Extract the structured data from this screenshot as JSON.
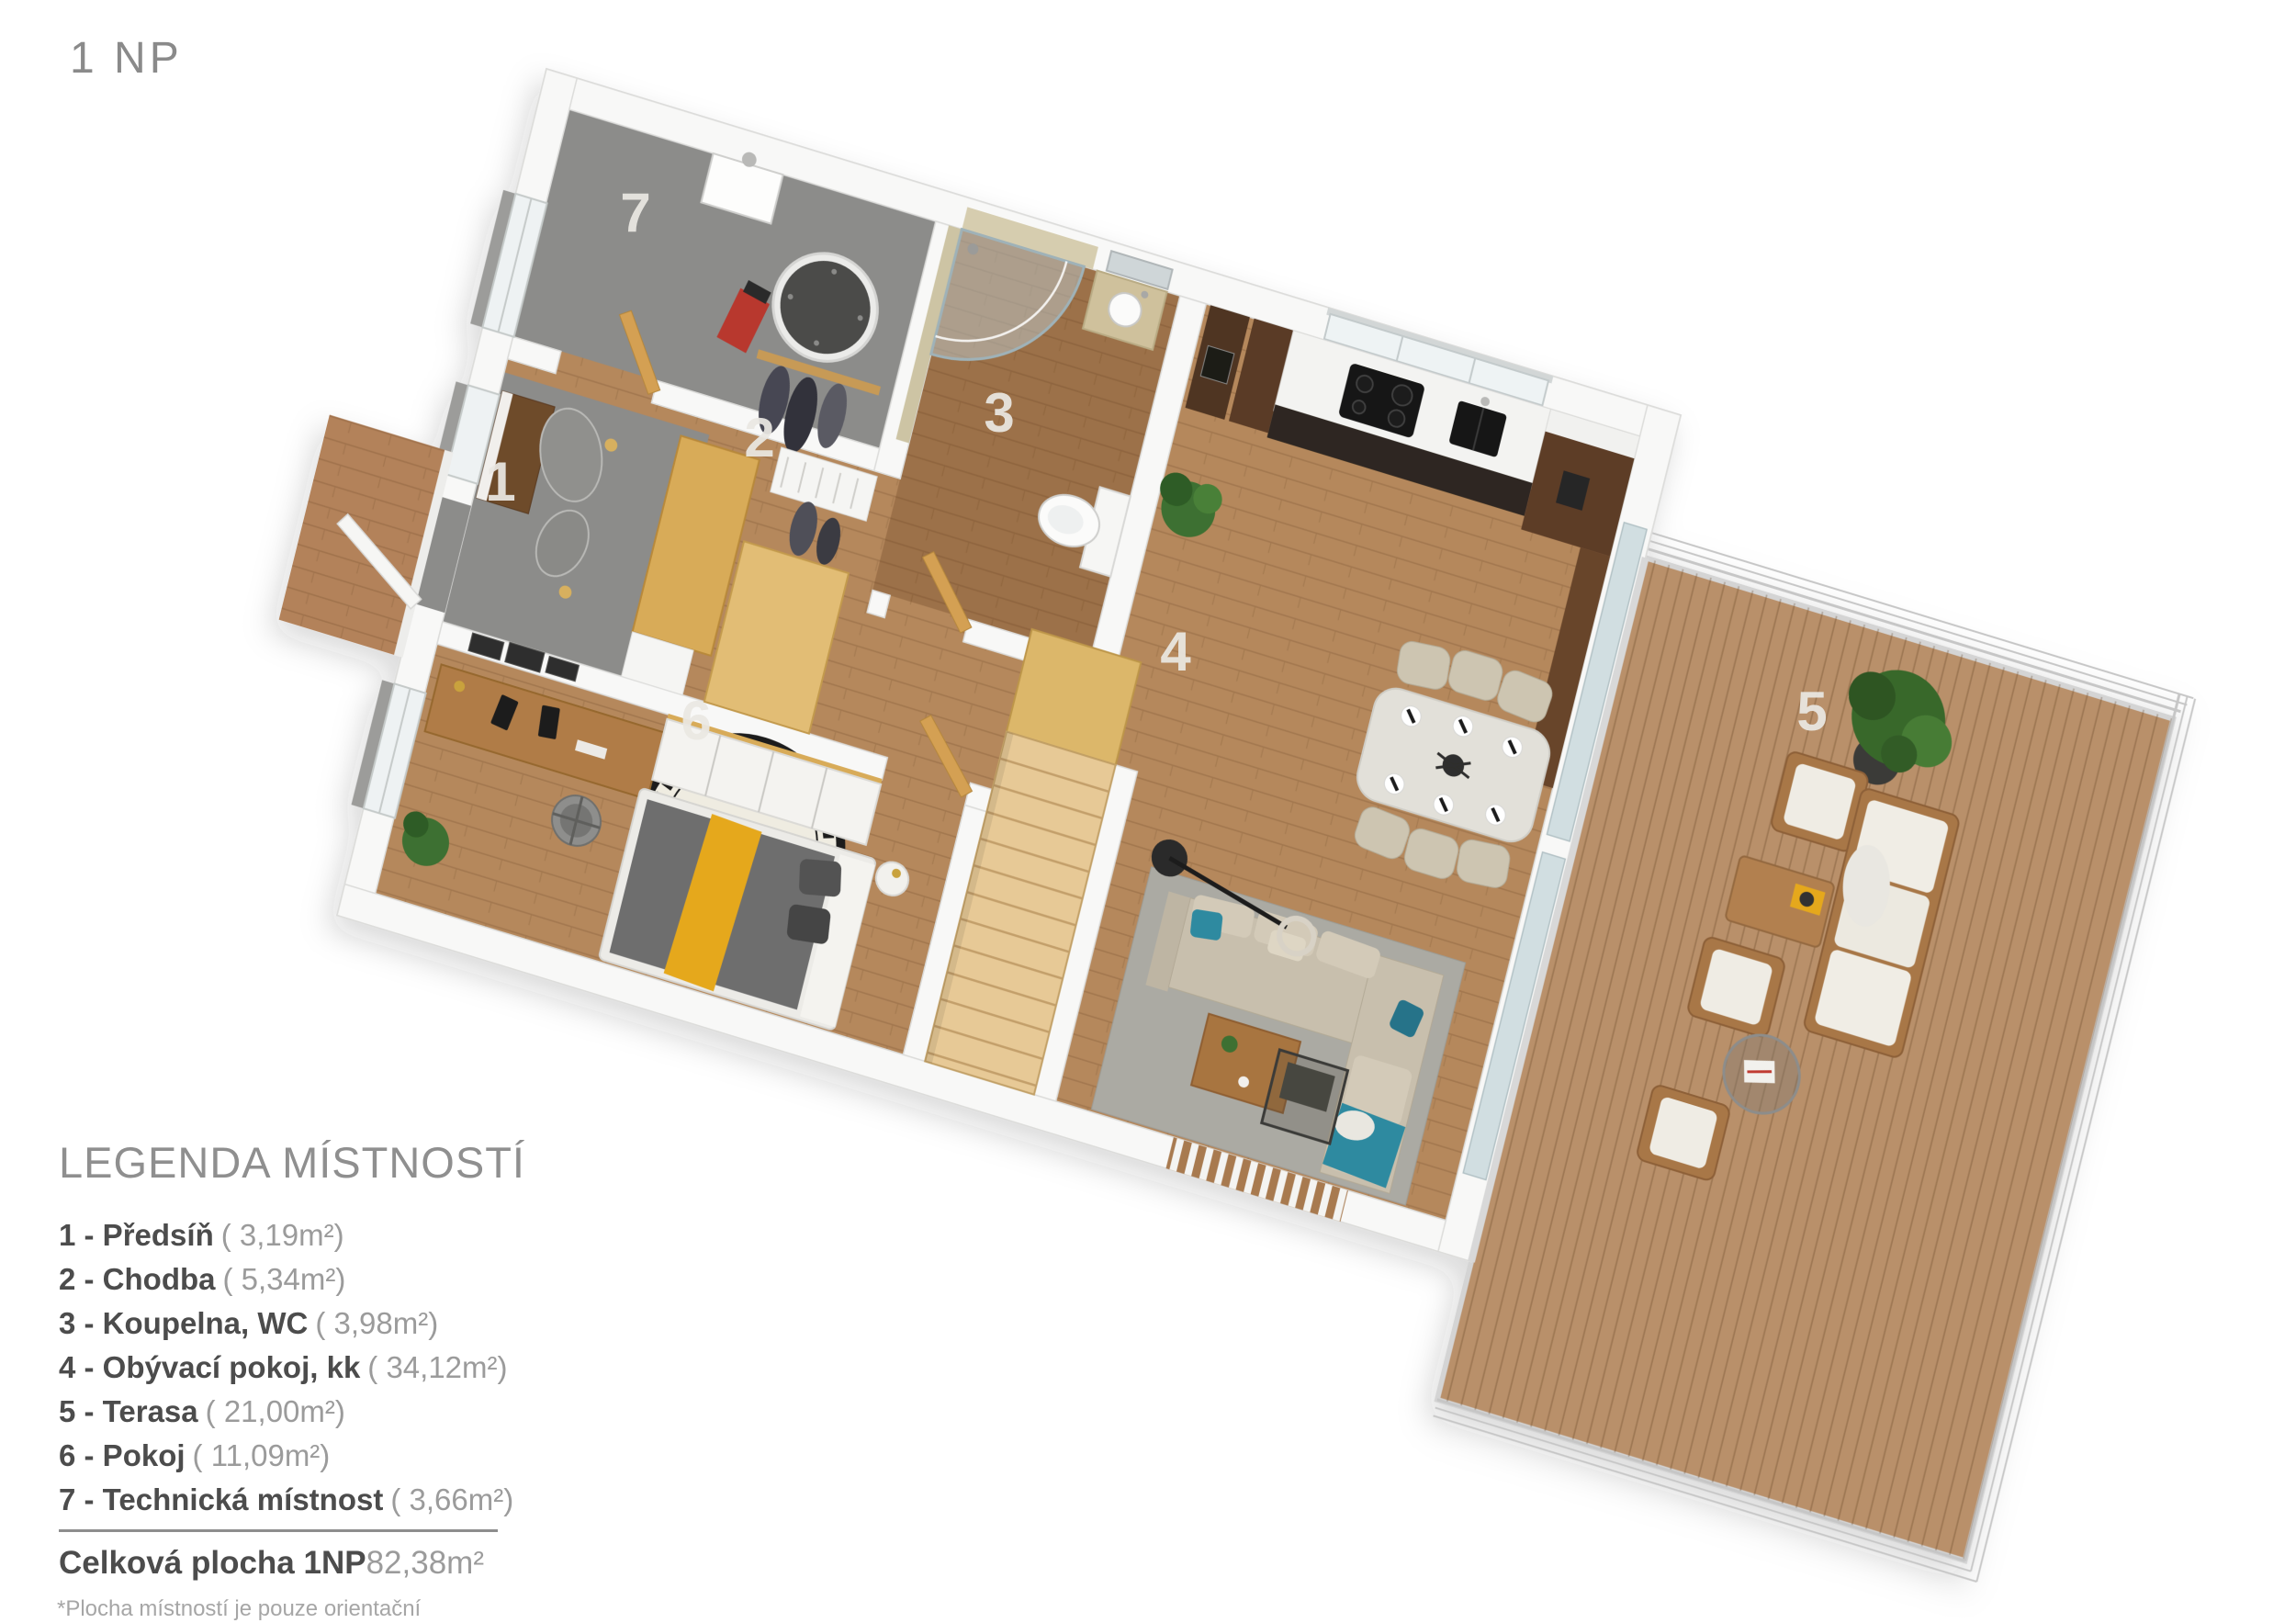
{
  "header": {
    "floor_label": "1 NP"
  },
  "legend": {
    "title": "LEGENDA MÍSTNOSTÍ",
    "rooms": [
      {
        "number": "1",
        "label": "1 - Předsíň",
        "area": "( 3,19m²)"
      },
      {
        "number": "2",
        "label": "2 - Chodba",
        "area": "( 5,34m²)"
      },
      {
        "number": "3",
        "label": "3 - Koupelna, WC",
        "area": "( 3,98m²)"
      },
      {
        "number": "4",
        "label": "4 - Obývací pokoj, kk",
        "area": "( 34,12m²)"
      },
      {
        "number": "5",
        "label": "5 - Terasa",
        "area": "( 21,00m²)"
      },
      {
        "number": "6",
        "label": "6 - Pokoj",
        "area": "( 11,09m²)"
      },
      {
        "number": "7",
        "label": "7 - Technická místnost",
        "area": "( 3,66m²)"
      }
    ],
    "total": {
      "label": "Celková plocha 1NP",
      "value": "82,38m²"
    },
    "footnote": "*Plocha místností je pouze orientační"
  },
  "colors": {
    "wood_floor": "#b5885c",
    "bath_floor_tint": "rgba(98,58,28,0.30)",
    "gray_floor": "#8c8c8a",
    "terrace_deck": "#b9906a",
    "porch_deck": "#b3825a",
    "stairs": "#e7c996",
    "oak_door": "#d4a052",
    "walnut_dark": "#553823",
    "accent_teal": "#2e8aa0",
    "accent_yellow": "#e5a81f",
    "wall": "#f8f8f7",
    "number_gray": "#e9e7e2"
  }
}
